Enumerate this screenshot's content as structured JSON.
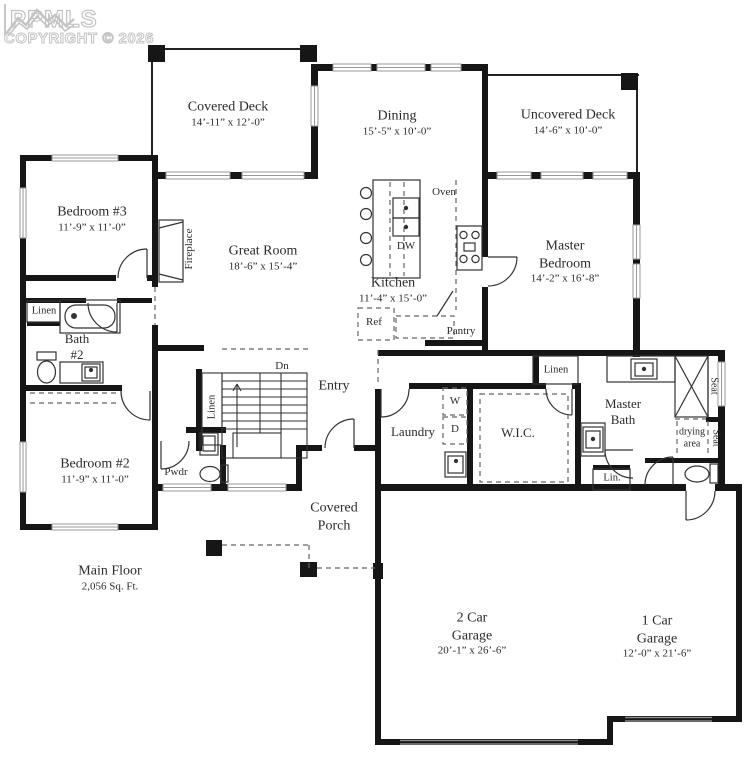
{
  "watermark": {
    "brand": "PPMLS",
    "copyright": "COPYRIGHT © 2026"
  },
  "rooms": {
    "covered_deck": {
      "name": "Covered Deck",
      "dims": "14’-11” x 12’-0”"
    },
    "dining": {
      "name": "Dining",
      "dims": "15’-5” x 10’-0”"
    },
    "uncovered_deck": {
      "name": "Uncovered Deck",
      "dims": "14’-6” x 10’-0”"
    },
    "bedroom3": {
      "name": "Bedroom #3",
      "dims": "11’-9” x 11’-0”"
    },
    "great_room": {
      "name": "Great Room",
      "dims": "18’-6” x 15’-4”"
    },
    "kitchen": {
      "name": "Kitchen",
      "dims": "11’-4” x 15’-0”"
    },
    "master_bedroom": {
      "name": "Master Bedroom",
      "dims": "14’-2” x 16’-8”"
    },
    "bath2": {
      "name": "Bath #2"
    },
    "bedroom2": {
      "name": "Bedroom #2",
      "dims": "11’-9” x 11’-0”"
    },
    "entry": {
      "name": "Entry"
    },
    "laundry": {
      "name": "Laundry"
    },
    "wic": {
      "name": "W.I.C."
    },
    "master_bath": {
      "name": "Master Bath"
    },
    "covered_porch": {
      "name": "Covered Porch"
    },
    "garage2": {
      "name": "2 Car Garage",
      "dims": "20’-1” x 26’-6”"
    },
    "garage1": {
      "name": "1 Car Garage",
      "dims": "12’-0” x 21’-6”"
    }
  },
  "labels": {
    "fireplace": "Fireplace",
    "linen": "Linen",
    "oven": "Oven",
    "dw": "DW",
    "ref": "Ref",
    "pantry": "Pantry",
    "pwdr": "Pwdr",
    "dn": "Dn",
    "washer": "W",
    "dryer": "D",
    "seat": "Seat",
    "drying_area": "drying area",
    "lin": "Lin.",
    "main_floor": "Main Floor",
    "area_sqft": "2,056 Sq. Ft."
  }
}
